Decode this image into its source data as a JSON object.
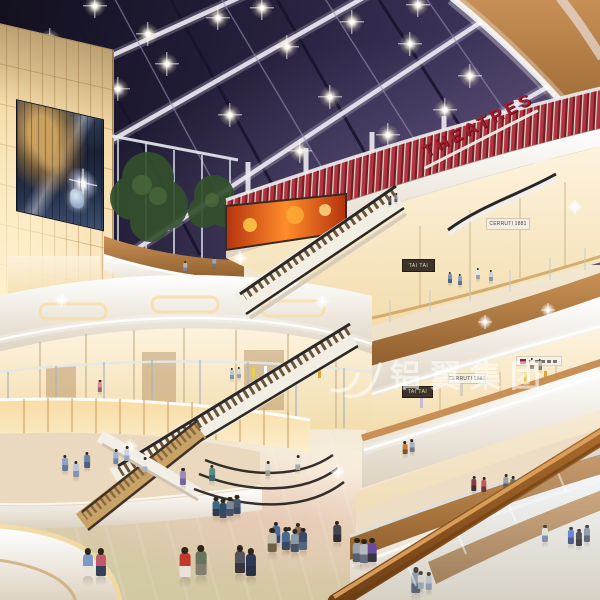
{
  "meta": {
    "canvas": {
      "w": 600,
      "h": 600
    },
    "scene": "shopping mall atrium interior rendering, multi-level curved balconies, night skylight"
  },
  "signs": {
    "theatres": "THEATRES",
    "tai_tai_upper": "TAI TAI",
    "cerruti_upper": "CERRUTI 1881",
    "tai_tai_lower": "TAI TAI",
    "cerruti_lower": "CERRUTI 1881"
  },
  "watermark": {
    "text": "铝翼集团"
  },
  "colors": {
    "sky": "#221e37",
    "sky_light": "#5a4b72",
    "beam": "#ece7f2",
    "mullion": "#17132a",
    "theatre_red": "#b23440",
    "theatre_red_dark": "#701d24",
    "sign_red": "#a01e2d",
    "wood": "#c89055",
    "wood_dark": "#8f5f2d",
    "rail": "#a96a2c",
    "rail_dark": "#6f3f15",
    "fascia": "#f7f2e9",
    "fascia_shadow": "#ddd2c0",
    "glow": "#f7dca4",
    "glow_bright": "#fdeecd",
    "panel_line": "#c49a5e",
    "store": "#fdf3de",
    "store_warm": "#f3ddae",
    "floor": "#e6d5bb",
    "floor_dark": "#cbb394",
    "glass": "#c6d4da",
    "tree": "#33502c",
    "tree_light": "#4d6c3e",
    "screen_orange": "#ff8c2a",
    "screen_red": "#b5330f",
    "steps": "#6a5438",
    "handrail_dark": "#2b2724",
    "watermark": "rgba(255,255,255,0.58)"
  },
  "ceiling_lights": [
    {
      "x": 95,
      "y": 6
    },
    {
      "x": 50,
      "y": 40
    },
    {
      "x": 148,
      "y": 34
    },
    {
      "x": 218,
      "y": 18
    },
    {
      "x": 167,
      "y": 64
    },
    {
      "x": 118,
      "y": 89
    },
    {
      "x": 287,
      "y": 47
    },
    {
      "x": 230,
      "y": 115
    },
    {
      "x": 352,
      "y": 22
    },
    {
      "x": 410,
      "y": 44
    },
    {
      "x": 330,
      "y": 97
    },
    {
      "x": 388,
      "y": 135
    },
    {
      "x": 300,
      "y": 151
    },
    {
      "x": 445,
      "y": 110
    },
    {
      "x": 262,
      "y": 8
    },
    {
      "x": 418,
      "y": 5
    },
    {
      "x": 470,
      "y": 76
    }
  ],
  "sparkles": [
    {
      "x": 485,
      "y": 322
    },
    {
      "x": 548,
      "y": 310
    },
    {
      "x": 322,
      "y": 302
    },
    {
      "x": 62,
      "y": 300
    },
    {
      "x": 130,
      "y": 446
    },
    {
      "x": 338,
      "y": 472
    },
    {
      "x": 575,
      "y": 207
    },
    {
      "x": 240,
      "y": 258
    }
  ],
  "people": [
    {
      "x": 390,
      "y": 207,
      "h": 9,
      "c": "#5a5a64",
      "p": "#3c3c46"
    },
    {
      "x": 396,
      "y": 204,
      "h": 9,
      "c": "#8a8a94",
      "p": "#5a5a64"
    },
    {
      "x": 185,
      "y": 273,
      "h": 10,
      "c": "#b0b8c8",
      "p": "#7e8696"
    },
    {
      "x": 214,
      "y": 269,
      "h": 10,
      "c": "#98a8b8",
      "p": "#68788a"
    },
    {
      "x": 450,
      "y": 285,
      "h": 11,
      "c": "#7a92b8",
      "p": "#4e6288"
    },
    {
      "x": 460,
      "y": 287,
      "h": 11,
      "c": "#8aa2c0",
      "p": "#5a7494"
    },
    {
      "x": 478,
      "y": 281,
      "h": 11,
      "c": "#e6e6e6",
      "p": "#9aa2ac"
    },
    {
      "x": 491,
      "y": 283,
      "h": 11,
      "c": "#c8d2dc",
      "p": "#8a94a0"
    },
    {
      "x": 532,
      "y": 371,
      "h": 11,
      "c": "#e8e0d0",
      "p": "#a08a6a"
    },
    {
      "x": 540,
      "y": 372,
      "h": 11,
      "c": "#c8b8a0",
      "p": "#8a7a60"
    },
    {
      "x": 100,
      "y": 394,
      "h": 12,
      "c": "#d88a9a",
      "p": "#96606e"
    },
    {
      "x": 232,
      "y": 381,
      "h": 11,
      "c": "#b8c8d8",
      "p": "#8494a6"
    },
    {
      "x": 239,
      "y": 380,
      "h": 11,
      "c": "#d8d8d8",
      "p": "#9aa2ae"
    },
    {
      "x": 65,
      "y": 474,
      "h": 16,
      "c": "#8aa2c8",
      "p": "#65789a"
    },
    {
      "x": 76,
      "y": 480,
      "h": 16,
      "c": "#b8c4d8",
      "p": "#8792a8"
    },
    {
      "x": 87,
      "y": 471,
      "h": 16,
      "c": "#6a82a8",
      "p": "#4c6084"
    },
    {
      "x": 116,
      "y": 467,
      "h": 15,
      "c": "#98b4d4",
      "p": "#6d85a8"
    },
    {
      "x": 127,
      "y": 464,
      "h": 15,
      "c": "#c8d4e4",
      "p": "#93a5c0"
    },
    {
      "x": 145,
      "y": 475,
      "h": 15,
      "c": "#ececec",
      "p": "#aab2be"
    },
    {
      "x": 183,
      "y": 488,
      "h": 17,
      "c": "#9a8ab8",
      "p": "#74689a"
    },
    {
      "x": 212,
      "y": 484,
      "h": 16,
      "c": "#5a8a8a",
      "p": "#3f6a6a"
    },
    {
      "x": 268,
      "y": 479,
      "h": 15,
      "c": "#d8d8d0",
      "p": "#969e96"
    },
    {
      "x": 298,
      "y": 473,
      "h": 15,
      "c": "#eae8e0",
      "p": "#a4aca4"
    },
    {
      "x": 216,
      "y": 520,
      "h": 19,
      "c": "#3a6a7a",
      "p": "#2c3c50"
    },
    {
      "x": 223,
      "y": 522,
      "h": 19,
      "c": "#2e4a6a",
      "p": "#3a4a60"
    },
    {
      "x": 230,
      "y": 520,
      "h": 19,
      "c": "#7a8a9a",
      "p": "#46526a"
    },
    {
      "x": 237,
      "y": 518,
      "h": 19,
      "c": "#4a5a72",
      "p": "#38485e"
    },
    {
      "x": 276,
      "y": 547,
      "h": 21,
      "c": "#4a6a9a",
      "p": "#32457a"
    },
    {
      "x": 289,
      "y": 552,
      "h": 21,
      "c": "#e0ddd4",
      "p": "#847c6e"
    },
    {
      "x": 298,
      "y": 548,
      "h": 21,
      "c": "#8a6a5a",
      "p": "#52402f"
    },
    {
      "x": 272,
      "y": 557,
      "h": 24,
      "c": "#c8bfa8",
      "p": "#6f6046"
    },
    {
      "x": 286,
      "y": 555,
      "h": 23,
      "c": "#48698c",
      "p": "#364a68"
    },
    {
      "x": 295,
      "y": 557,
      "h": 23,
      "c": "#8a9aa8",
      "p": "#465468"
    },
    {
      "x": 303,
      "y": 554,
      "h": 22,
      "c": "#3a4a66",
      "p": "#55657c"
    },
    {
      "x": 337,
      "y": 546,
      "h": 21,
      "c": "#46464e",
      "p": "#2e2e36"
    },
    {
      "x": 357,
      "y": 567,
      "h": 24,
      "c": "#9aa2aa",
      "p": "#555e6c"
    },
    {
      "x": 364,
      "y": 568,
      "h": 24,
      "c": "#b8b8c0",
      "p": "#656d7c"
    },
    {
      "x": 372,
      "y": 567,
      "h": 24,
      "c": "#6a4a9a",
      "p": "#36363e"
    },
    {
      "x": 240,
      "y": 579,
      "h": 28,
      "c": "#54545c",
      "p": "#36363c"
    },
    {
      "x": 251,
      "y": 582,
      "h": 28,
      "c": "#2e3a55",
      "p": "#283048"
    },
    {
      "x": 185,
      "y": 583,
      "h": 30,
      "c": "#c0392b",
      "p": "#e8e2d8"
    },
    {
      "x": 201,
      "y": 581,
      "h": 30,
      "c": "#67755a",
      "p": "#837e6f"
    },
    {
      "x": 88,
      "y": 582,
      "h": 28,
      "c": "#7a9ac8",
      "p": "#e8e4da"
    },
    {
      "x": 101,
      "y": 582,
      "h": 28,
      "c": "#c05a6a",
      "p": "#36405a"
    },
    {
      "x": 416,
      "y": 598,
      "h": 26,
      "c": "#8a94a2",
      "p": "#46505e"
    },
    {
      "x": 405,
      "y": 457,
      "h": 13,
      "c": "#c87a3a",
      "p": "#7e5229"
    },
    {
      "x": 412,
      "y": 455,
      "h": 13,
      "c": "#a8b4c0",
      "p": "#707c8c"
    },
    {
      "x": 474,
      "y": 494,
      "h": 15,
      "c": "#8a3a4a",
      "p": "#4f2833"
    },
    {
      "x": 484,
      "y": 495,
      "h": 15,
      "c": "#c05a5a",
      "p": "#6f343f"
    },
    {
      "x": 506,
      "y": 492,
      "h": 15,
      "c": "#9aa2aa",
      "p": "#555d69"
    },
    {
      "x": 513,
      "y": 494,
      "h": 15,
      "c": "#6a7a5a",
      "p": "#45523c"
    },
    {
      "x": 545,
      "y": 545,
      "h": 17,
      "c": "#e8e4dc",
      "p": "#7486a0"
    },
    {
      "x": 571,
      "y": 547,
      "h": 17,
      "c": "#5a7ac8",
      "p": "#35457a"
    },
    {
      "x": 579,
      "y": 549,
      "h": 17,
      "c": "#3a3a42",
      "p": "#26262c"
    },
    {
      "x": 587,
      "y": 545,
      "h": 17,
      "c": "#8a92a0",
      "p": "#4f5866"
    },
    {
      "x": 421,
      "y": 593,
      "h": 18,
      "c": "#d8d4cc",
      "p": "#93a0ad"
    },
    {
      "x": 429,
      "y": 594,
      "h": 18,
      "c": "#b8c0cc",
      "p": "#8893a3"
    }
  ]
}
